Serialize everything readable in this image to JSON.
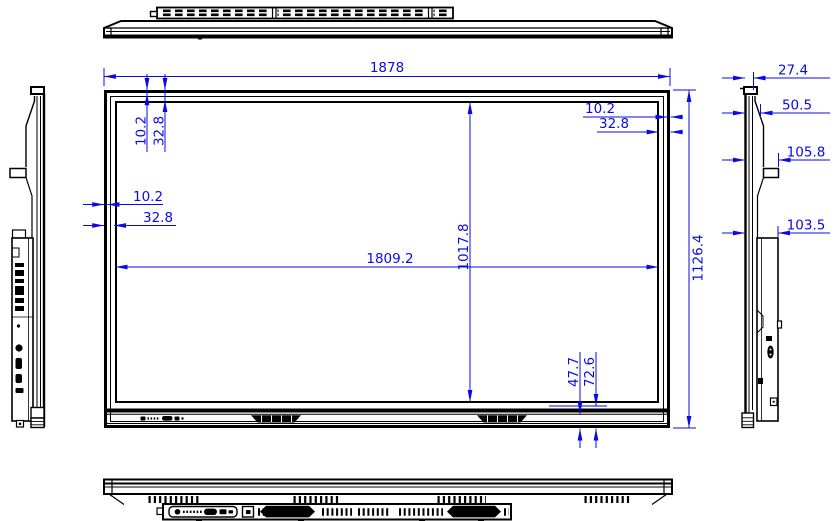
{
  "colors": {
    "dimension_accent": "#0a0ae6",
    "outline": "#000000",
    "background": "#ffffff"
  },
  "dims": {
    "overall_width": "1878",
    "overall_height": "1126.4",
    "active_width": "1809.2",
    "active_height": "1017.8",
    "bezel_top": {
      "outer": "10.2",
      "inner": "32.8"
    },
    "bezel_right": {
      "outer": "10.2",
      "inner": "32.8"
    },
    "bezel_left": {
      "outer": "10.2",
      "inner": "32.8"
    },
    "bezel_bottom": {
      "inner": "47.7",
      "outer": "72.6"
    },
    "side_profile": {
      "panel_thickness": "27.4",
      "front_depth": "50.5",
      "bracket_depth": "105.8",
      "body_depth": "103.5"
    }
  }
}
